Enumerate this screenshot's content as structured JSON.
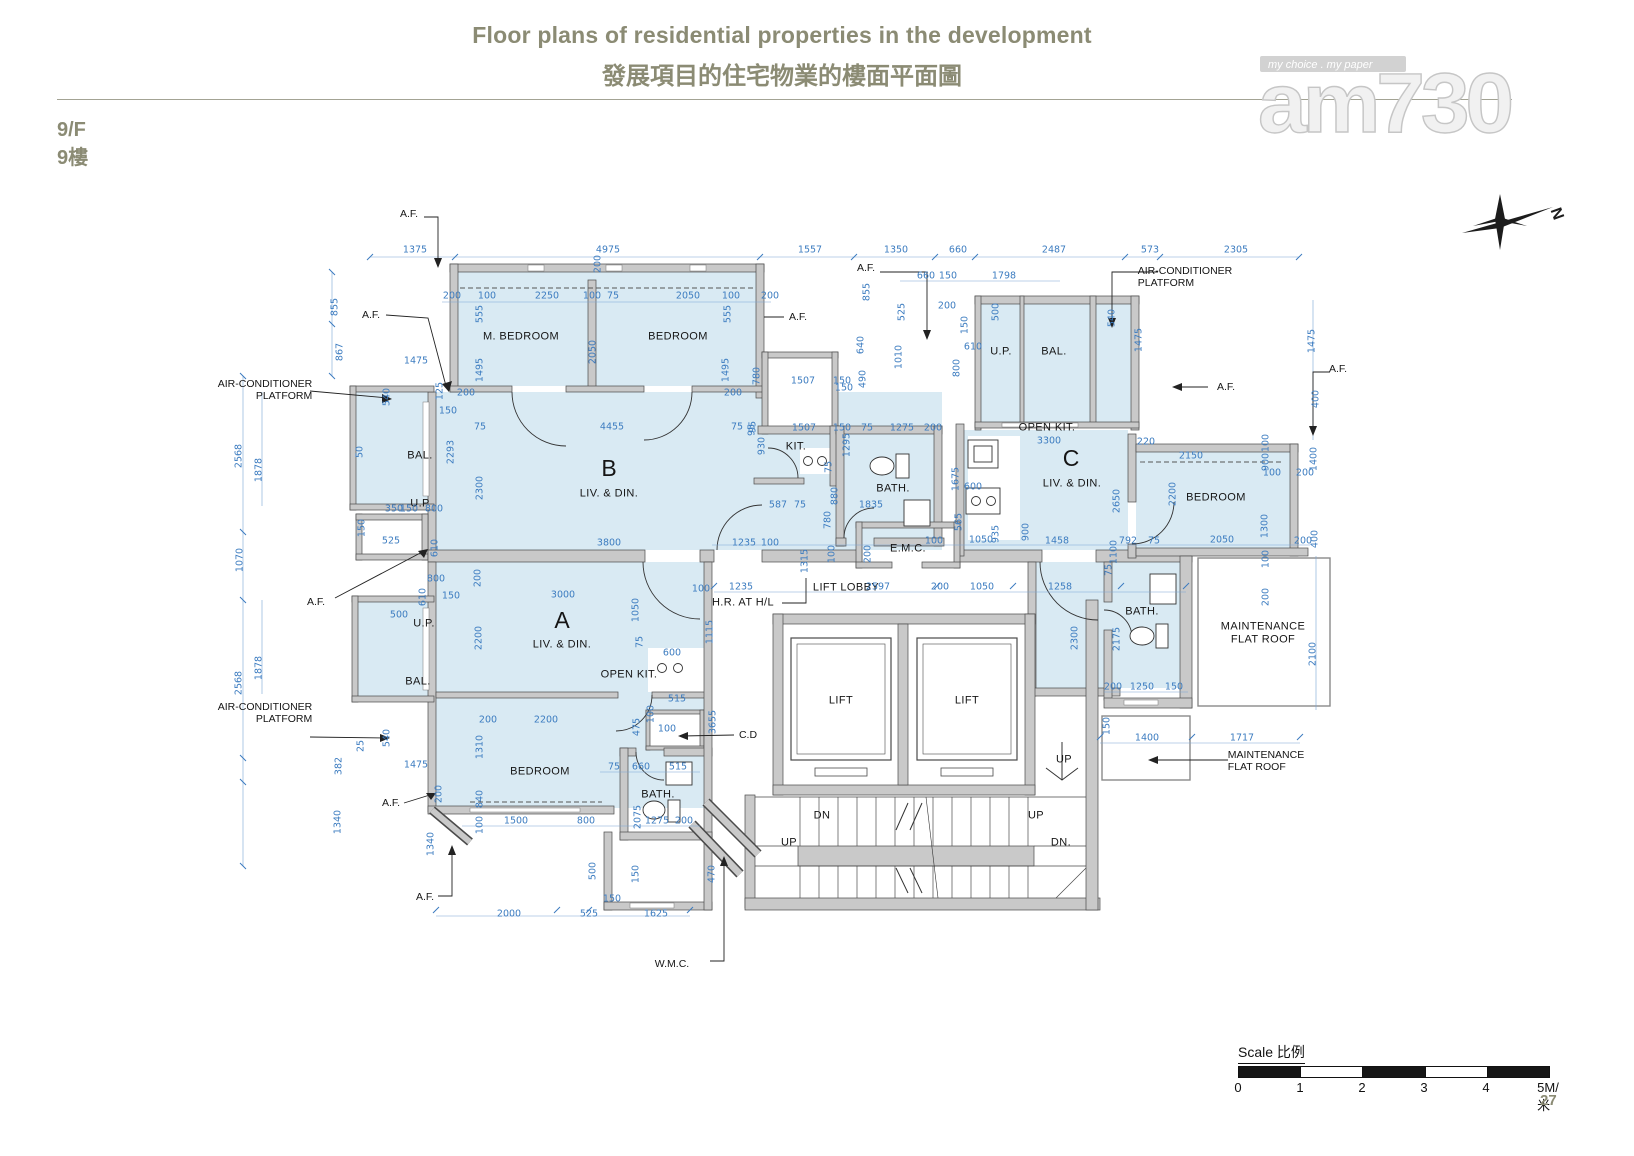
{
  "header": {
    "title_en": "Floor plans of residential properties in the development",
    "title_zh": "發展項目的住宅物業的樓面平面圖",
    "floor_en": "9/F",
    "floor_zh": "9樓",
    "page_number": "27",
    "logo": {
      "text": "am730",
      "tagline": "my choice . my paper"
    },
    "compass_label": "N"
  },
  "scale_bar": {
    "label": "Scale 比例",
    "ticks": [
      "0",
      "1",
      "2",
      "3",
      "4",
      "5M/米"
    ]
  },
  "plan": {
    "rooms": [
      [
        "M. BEDROOM",
        521,
        337
      ],
      [
        "BEDROOM",
        678,
        337
      ],
      [
        "B",
        609,
        468,
        "big"
      ],
      [
        "LIV. & DIN.",
        609,
        494
      ],
      [
        "BAL.",
        420,
        456
      ],
      [
        "U.P",
        420,
        504
      ],
      [
        "KIT.",
        796,
        447
      ],
      [
        "BATH.",
        893,
        489
      ],
      [
        "U.P.",
        1001,
        352
      ],
      [
        "BAL.",
        1054,
        352
      ],
      [
        "OPEN KIT.",
        1047,
        428
      ],
      [
        "C",
        1071,
        458,
        "big"
      ],
      [
        "LIV. & DIN.",
        1072,
        484
      ],
      [
        "BEDROOM",
        1216,
        498
      ],
      [
        "BATH.",
        1142,
        612
      ],
      [
        "A",
        562,
        620,
        "big"
      ],
      [
        "LIV. & DIN.",
        562,
        645
      ],
      [
        "U.P.",
        424,
        624
      ],
      [
        "BAL.",
        418,
        682
      ],
      [
        "OPEN KIT.",
        629,
        675
      ],
      [
        "BEDROOM",
        540,
        772
      ],
      [
        "BATH.",
        658,
        795
      ],
      [
        "LIFT LOBBY",
        846,
        588
      ],
      [
        "E.M.C.",
        908,
        549
      ],
      [
        "LIFT",
        841,
        701
      ],
      [
        "LIFT",
        967,
        701
      ],
      [
        "MAINTENANCE\nFLAT ROOF",
        1263,
        633,
        "two"
      ],
      [
        "H.R. AT H/L",
        743,
        603
      ],
      [
        "UP",
        1064,
        760
      ],
      [
        "DN",
        822,
        816
      ],
      [
        "UP",
        1036,
        816
      ],
      [
        "UP",
        789,
        843
      ],
      [
        "DN.",
        1061,
        843
      ]
    ],
    "annotations": [
      [
        "A.F.",
        409,
        214
      ],
      [
        "A.F.",
        371,
        315
      ],
      [
        "A.F.",
        798,
        317
      ],
      [
        "A.F.",
        866,
        268
      ],
      [
        "A.F.",
        316,
        602
      ],
      [
        "A.F.",
        391,
        803
      ],
      [
        "A.F.",
        425,
        897
      ],
      [
        "A.F.",
        1226,
        387
      ],
      [
        "A.F.",
        1338,
        369
      ],
      [
        "AIR-CONDITIONER\nPLATFORM",
        265,
        390,
        "ra"
      ],
      [
        "AIR-CONDITIONER\nPLATFORM",
        265,
        713,
        "ra"
      ],
      [
        "AIR-CONDITIONER\nPLATFORM",
        1185,
        277,
        "la"
      ],
      [
        "C.D",
        748,
        735
      ],
      [
        "W.M.C.",
        672,
        964
      ],
      [
        "MAINTENANCE\nFLAT ROOF",
        1266,
        761,
        "la"
      ]
    ],
    "dims": [
      [
        "1375",
        415,
        251
      ],
      [
        "4975",
        608,
        251
      ],
      [
        "200",
        599,
        264,
        "v"
      ],
      [
        "1557",
        810,
        251
      ],
      [
        "1350",
        896,
        251
      ],
      [
        "660",
        958,
        251
      ],
      [
        "2487",
        1054,
        251
      ],
      [
        "573",
        1150,
        251
      ],
      [
        "2305",
        1236,
        251
      ],
      [
        "200",
        452,
        297
      ],
      [
        "100",
        487,
        297
      ],
      [
        "2250",
        547,
        297
      ],
      [
        "100",
        592,
        297
      ],
      [
        "75",
        613,
        297
      ],
      [
        "2050",
        688,
        297
      ],
      [
        "100",
        731,
        297
      ],
      [
        "200",
        770,
        297
      ],
      [
        "555",
        481,
        314,
        "v"
      ],
      [
        "1495",
        481,
        370,
        "v"
      ],
      [
        "2050",
        594,
        352,
        "v"
      ],
      [
        "555",
        729,
        314,
        "v"
      ],
      [
        "1495",
        727,
        370,
        "v"
      ],
      [
        "200",
        466,
        394
      ],
      [
        "200",
        733,
        394
      ],
      [
        "4455",
        612,
        428
      ],
      [
        "75",
        480,
        428
      ],
      [
        "75",
        737,
        428
      ],
      [
        "95",
        753,
        430,
        "v"
      ],
      [
        "855",
        336,
        307,
        "v"
      ],
      [
        "867",
        341,
        352,
        "v"
      ],
      [
        "1475",
        416,
        362
      ],
      [
        "540",
        388,
        397,
        "v"
      ],
      [
        "125",
        441,
        391,
        "v"
      ],
      [
        "150",
        448,
        412
      ],
      [
        "2568",
        240,
        456,
        "v"
      ],
      [
        "1878",
        260,
        470,
        "v"
      ],
      [
        "2293",
        452,
        452,
        "v"
      ],
      [
        "2300",
        481,
        488,
        "v"
      ],
      [
        "350",
        394,
        510
      ],
      [
        "150",
        409,
        510
      ],
      [
        "800",
        434,
        510
      ],
      [
        "50",
        361,
        452,
        "v"
      ],
      [
        "525",
        391,
        542
      ],
      [
        "1070",
        241,
        560,
        "v"
      ],
      [
        "150",
        363,
        528,
        "v"
      ],
      [
        "610",
        436,
        548,
        "v"
      ],
      [
        "800",
        436,
        580
      ],
      [
        "610",
        424,
        597,
        "v"
      ],
      [
        "150",
        451,
        597
      ],
      [
        "200",
        479,
        578,
        "v"
      ],
      [
        "500",
        399,
        616
      ],
      [
        "1878",
        260,
        668,
        "v"
      ],
      [
        "2568",
        240,
        683,
        "v"
      ],
      [
        "540",
        388,
        738,
        "v"
      ],
      [
        "25",
        362,
        746,
        "v"
      ],
      [
        "1475",
        416,
        766
      ],
      [
        "382",
        340,
        766,
        "v"
      ],
      [
        "1340",
        339,
        822,
        "v"
      ],
      [
        "200",
        440,
        794,
        "v"
      ],
      [
        "1340",
        432,
        844,
        "v"
      ],
      [
        "3800",
        609,
        544
      ],
      [
        "1235",
        744,
        544
      ],
      [
        "100",
        770,
        544
      ],
      [
        "3000",
        563,
        596
      ],
      [
        "1050",
        637,
        610,
        "v"
      ],
      [
        "2200",
        480,
        638,
        "v"
      ],
      [
        "75",
        641,
        642,
        "v"
      ],
      [
        "600",
        672,
        654
      ],
      [
        "1115",
        711,
        632,
        "v"
      ],
      [
        "3655",
        714,
        722,
        "v"
      ],
      [
        "100",
        701,
        590
      ],
      [
        "1235",
        741,
        588
      ],
      [
        "2597",
        878,
        588
      ],
      [
        "200",
        940,
        588
      ],
      [
        "1050",
        982,
        588
      ],
      [
        "1258",
        1060,
        588
      ],
      [
        "1315",
        806,
        561,
        "v"
      ],
      [
        "100",
        833,
        554,
        "v"
      ],
      [
        "200",
        869,
        554,
        "v"
      ],
      [
        "100",
        934,
        542
      ],
      [
        "1050",
        981,
        541
      ],
      [
        "935",
        997,
        534,
        "v"
      ],
      [
        "900",
        1027,
        532,
        "v"
      ],
      [
        "1458",
        1057,
        542
      ],
      [
        "792",
        1128,
        542
      ],
      [
        "75",
        1154,
        542
      ],
      [
        "1100",
        1115,
        552,
        "v"
      ],
      [
        "75",
        1110,
        570,
        "v"
      ],
      [
        "660",
        926,
        277
      ],
      [
        "150",
        948,
        277
      ],
      [
        "1798",
        1004,
        277
      ],
      [
        "200",
        947,
        307
      ],
      [
        "540",
        1113,
        318,
        "v"
      ],
      [
        "1475",
        1140,
        340,
        "v"
      ],
      [
        "500",
        997,
        312,
        "v"
      ],
      [
        "150",
        966,
        325,
        "v"
      ],
      [
        "610",
        973,
        348
      ],
      [
        "800",
        958,
        368,
        "v"
      ],
      [
        "855",
        868,
        292,
        "v"
      ],
      [
        "525",
        903,
        312,
        "v"
      ],
      [
        "640",
        862,
        345,
        "v"
      ],
      [
        "1010",
        900,
        357,
        "v"
      ],
      [
        "490",
        864,
        379,
        "v"
      ],
      [
        "150",
        844,
        389
      ],
      [
        "780",
        758,
        376,
        "v"
      ],
      [
        "1507",
        803,
        382
      ],
      [
        "150",
        842,
        382
      ],
      [
        "930",
        763,
        446,
        "v"
      ],
      [
        "95",
        754,
        427,
        "v"
      ],
      [
        "1507",
        804,
        429
      ],
      [
        "150",
        842,
        429
      ],
      [
        "75",
        867,
        429
      ],
      [
        "1275",
        902,
        429
      ],
      [
        "200",
        933,
        429
      ],
      [
        "1295",
        848,
        445,
        "v"
      ],
      [
        "75",
        830,
        467,
        "v"
      ],
      [
        "880",
        836,
        496,
        "v"
      ],
      [
        "780",
        829,
        520,
        "v"
      ],
      [
        "587",
        778,
        506
      ],
      [
        "75",
        800,
        506
      ],
      [
        "1835",
        871,
        506
      ],
      [
        "1675",
        957,
        479,
        "v"
      ],
      [
        "600",
        973,
        488
      ],
      [
        "565",
        960,
        522,
        "v"
      ],
      [
        "3300",
        1049,
        442
      ],
      [
        "220",
        1146,
        443
      ],
      [
        "2150",
        1191,
        457
      ],
      [
        "900",
        1267,
        462,
        "v"
      ],
      [
        "100",
        1267,
        443,
        "v"
      ],
      [
        "1400",
        1315,
        459,
        "v"
      ],
      [
        "100",
        1272,
        474
      ],
      [
        "200",
        1305,
        474
      ],
      [
        "2650",
        1118,
        501,
        "v"
      ],
      [
        "2200",
        1174,
        494,
        "v"
      ],
      [
        "1300",
        1266,
        526,
        "v"
      ],
      [
        "2050",
        1222,
        541
      ],
      [
        "200",
        1303,
        542
      ],
      [
        "400",
        1316,
        539,
        "v"
      ],
      [
        "100",
        1267,
        559,
        "v"
      ],
      [
        "200",
        1267,
        597,
        "v"
      ],
      [
        "1475",
        1313,
        341,
        "v"
      ],
      [
        "400",
        1317,
        399,
        "v"
      ],
      [
        "2300",
        1076,
        638,
        "v"
      ],
      [
        "2175",
        1118,
        639,
        "v"
      ],
      [
        "200",
        1113,
        688
      ],
      [
        "1250",
        1142,
        688
      ],
      [
        "150",
        1174,
        688
      ],
      [
        "150",
        1108,
        726,
        "v"
      ],
      [
        "1400",
        1147,
        739
      ],
      [
        "1717",
        1242,
        739
      ],
      [
        "2100",
        1314,
        654,
        "v"
      ],
      [
        "200",
        488,
        721
      ],
      [
        "2200",
        546,
        721
      ],
      [
        "1310",
        481,
        747,
        "v"
      ],
      [
        "840",
        481,
        799,
        "v"
      ],
      [
        "100",
        481,
        825,
        "v"
      ],
      [
        "1500",
        516,
        822
      ],
      [
        "800",
        586,
        822
      ],
      [
        "2075",
        639,
        817,
        "v"
      ],
      [
        "1275",
        657,
        822
      ],
      [
        "200",
        684,
        822
      ],
      [
        "75",
        614,
        768
      ],
      [
        "660",
        641,
        768
      ],
      [
        "515",
        678,
        768
      ],
      [
        "100",
        667,
        730
      ],
      [
        "475",
        638,
        727,
        "v"
      ],
      [
        "100",
        652,
        714,
        "v"
      ],
      [
        "515",
        677,
        700
      ],
      [
        "2000",
        509,
        915
      ],
      [
        "525",
        589,
        915
      ],
      [
        "1625",
        656,
        915
      ],
      [
        "150",
        612,
        900
      ],
      [
        "500",
        594,
        871,
        "v"
      ],
      [
        "150",
        637,
        874,
        "v"
      ],
      [
        "470",
        713,
        874,
        "v"
      ]
    ]
  }
}
